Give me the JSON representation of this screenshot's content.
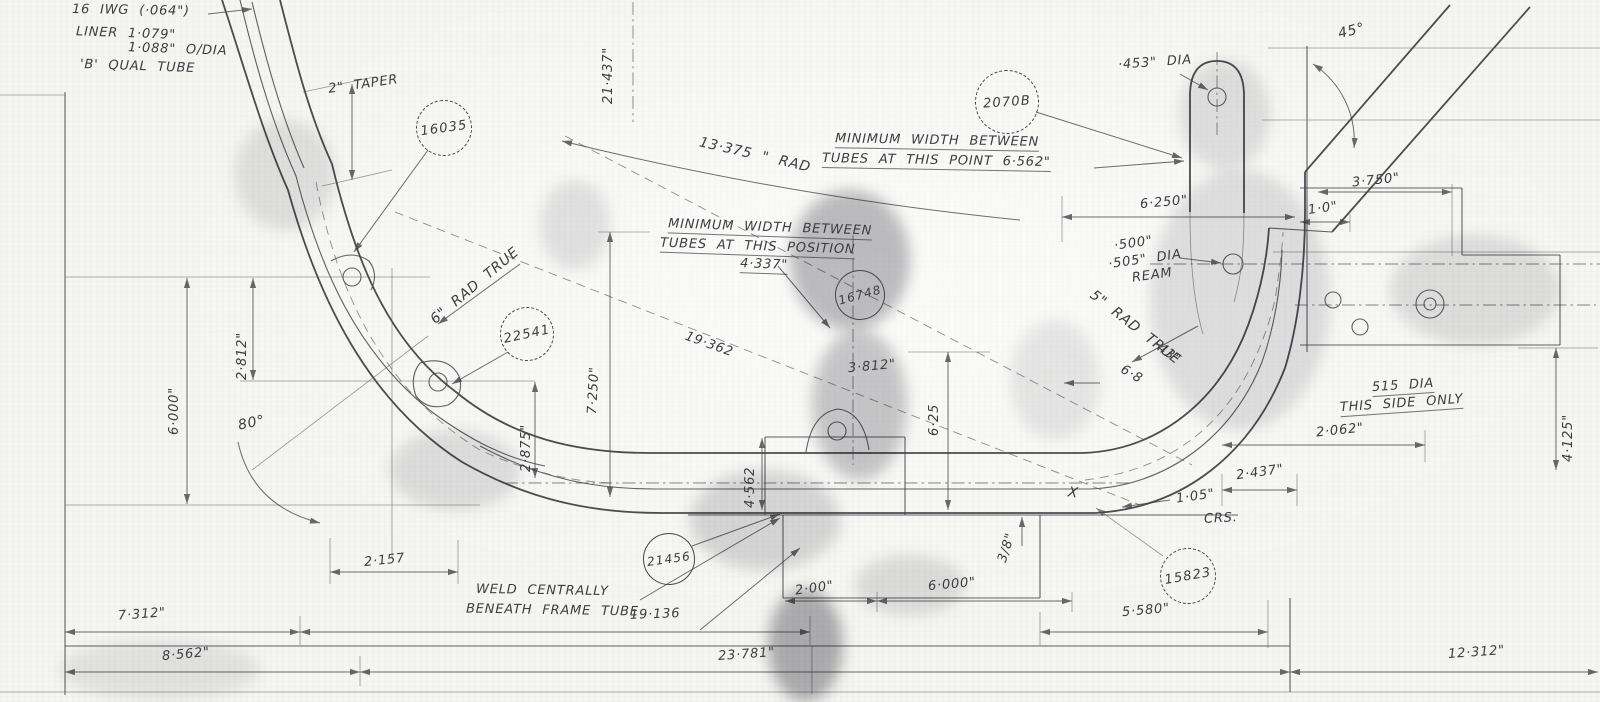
{
  "meta": {
    "description": "Scanned hand-drawn engineering blueprint of a frame tube assembly",
    "paper_color": "#f5f5f1",
    "ink_color": "#3c3c42"
  },
  "sheet": {
    "notes": {
      "gauge": "16 IWG (·064\")",
      "liner_top": "LINER  1·079\"",
      "liner_bottom": "1·088\"  O/DIA",
      "quality": "'B' QUAL TUBE",
      "min_point_1": "MINIMUM  WIDTH  BETWEEN",
      "min_point_2": "TUBES  AT  THIS  POINT  6·562\"",
      "min_pos_1": "MINIMUM  WIDTH  BETWEEN",
      "min_pos_2": "TUBES  AT  THIS  POSITION",
      "min_pos_3": "4·337\"",
      "ream_1": "·500\"",
      "ream_2": "·505\" DIA",
      "ream_3": "REAM",
      "side_1": "515 DIA",
      "side_2": "THIS SIDE ONLY",
      "crs": "CRS.",
      "weld_1": "WELD  CENTRALLY",
      "weld_2": "BENEATH  FRAME  TUBE"
    },
    "dims": {
      "taper": "2\" TAPER",
      "d21_437": "21·437\"",
      "rad13": "13·375 \" RAD",
      "dia453": "·453\" DIA",
      "a45": "45°",
      "d3_750": "3·750\"",
      "d1_0": "1·0\"",
      "d6_250": "6·250\"",
      "rad6": "6\" RAD TRUE",
      "rad5": "5\" RAD TRUE",
      "d_43": "·43\"",
      "d6_8": "6·8",
      "d2_812": "2·812\"",
      "d6_000_left": "6·000\"",
      "a80": "80°",
      "d2_875": "2·875\"",
      "d7_250": "7·250\"",
      "d19_362": "19·362",
      "d3_812": "3·812\"",
      "d6_25": "6·25",
      "d2_062": "2·062\"",
      "d2_437": "2·437\"",
      "d1_05": "1·05\"",
      "d4_125": "4·125\"",
      "d4_562": "4·562",
      "d2_157": "2·157",
      "d2_00": "2·00\"",
      "d6_000_bottom": "6·000\"",
      "d3_8": "3/8\"",
      "d7_312": "7·312\"",
      "d19_136": "19·136",
      "d5_580": "5·580\"",
      "d8_562": "8·562\"",
      "d23_781": "23·781\"",
      "d12_312": "12·312\"",
      "x_mark": "X"
    },
    "balloons": {
      "b16035": "16035",
      "b2070b": "2070B",
      "b22541": "22541",
      "b16748": "16748",
      "b21456": "21456",
      "b15823": "15823"
    }
  }
}
